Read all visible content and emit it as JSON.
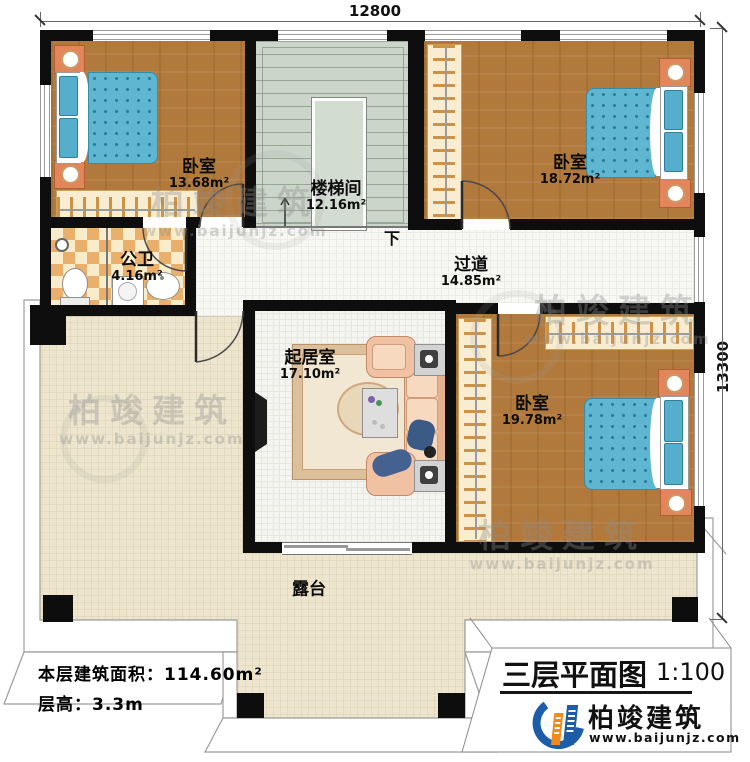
{
  "plan": {
    "dimensions": {
      "width_mm": "12800",
      "height_mm": "13300"
    },
    "rooms": [
      {
        "name": "卧室",
        "area": "13.68m²"
      },
      {
        "name": "楼梯间",
        "area": "12.16m²"
      },
      {
        "name": "卧室",
        "area": "18.72m²"
      },
      {
        "name": "公卫",
        "area": "4.16m²"
      },
      {
        "name": "过道",
        "area": "14.85m²"
      },
      {
        "name": "起居室",
        "area": "17.10m²"
      },
      {
        "name": "卧室",
        "area": "19.78m²"
      },
      {
        "name": "露台",
        "area": ""
      }
    ],
    "stair_down_label": "下",
    "info": {
      "area_label": "本层建筑面积：",
      "area_value": "114.60m²",
      "height_label": "层高：",
      "height_value": "3.3m"
    },
    "title_block": {
      "title": "三层平面图",
      "scale": "1:100",
      "brand": "柏竣建筑",
      "website": "www.baijunjz.com"
    },
    "watermark": {
      "brand": "柏竣建筑",
      "website": "www.baijunjz.com"
    },
    "colors": {
      "wall": "#0e0e0e",
      "wood": "#b1793c",
      "mattress": "#5fb6d1",
      "terrace": "#ede5cd",
      "stair": "#cbd5c9",
      "nightstand": "#e2855a",
      "brand_blue": "#1c5ca8",
      "brand_orange": "#f08a1f"
    }
  }
}
